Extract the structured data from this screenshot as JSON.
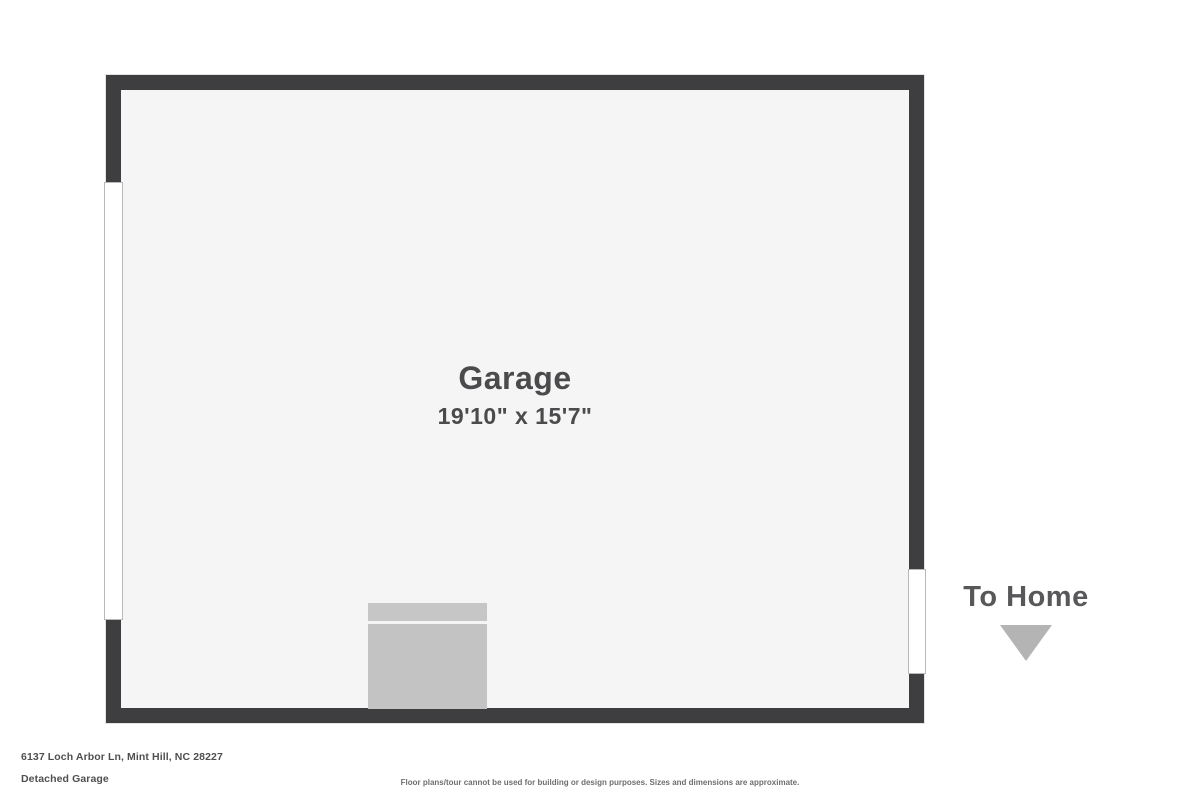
{
  "plan": {
    "room": {
      "label": "Garage",
      "dimensions": "19'10\" x 15'7\""
    },
    "annotations": {
      "to_home_label": "To Home",
      "to_home_arrow_icon": "triangle-down"
    },
    "features": {
      "left_wall_opening": "garage-door-opening",
      "right_wall_opening": "doorway-to-home",
      "fixture": "gray-utility-block"
    }
  },
  "footer": {
    "address": "6137 Loch Arbor Ln, Mint Hill, NC 28227",
    "plan_name": "Detached Garage",
    "disclaimer": "Floor plans/tour cannot be used for building or design purposes. Sizes and dimensions are approximate."
  },
  "colors": {
    "wall": "#3e3e40",
    "interior": "#f5f5f5",
    "fixture": "#c3c3c3",
    "arrow": "#b4b4b4",
    "text_dark": "#4b4b4d",
    "text_medium": "#58585a",
    "text_footer": "#4f4f51",
    "text_disclaimer": "#6e6e70"
  }
}
